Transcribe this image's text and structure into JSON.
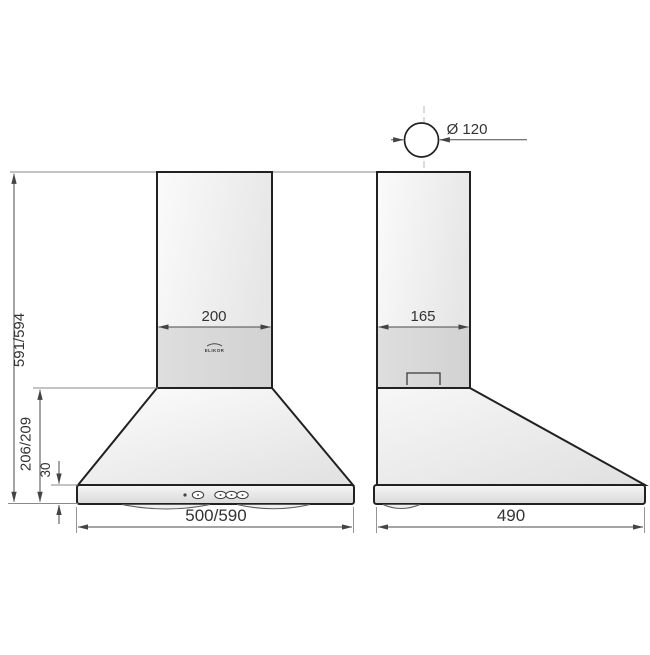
{
  "drawing": {
    "type": "technical-dimension-drawing",
    "product": "kitchen chimney hood",
    "brand_logo": "ELIKOR",
    "views": {
      "front": {
        "name": "front view",
        "dimensions": {
          "chimney_width": "200",
          "total_height": "591/594",
          "lower_body_height": "206/209",
          "base_height": "30",
          "body_width": "500/590"
        }
      },
      "side": {
        "name": "side view",
        "dimensions": {
          "duct_diameter": "Ø 120",
          "chimney_depth": "165",
          "body_depth": "490"
        }
      }
    },
    "colors": {
      "background": "#ffffff",
      "object_line": "#212121",
      "dimension_line": "#4a4a4a",
      "extension_line": "#8a8a8a",
      "centerline": "#b8b8b8",
      "fill_light": "#f7f7f7",
      "fill_mid": "#e4e4e4",
      "fill_dark": "#d6d6d6"
    }
  }
}
